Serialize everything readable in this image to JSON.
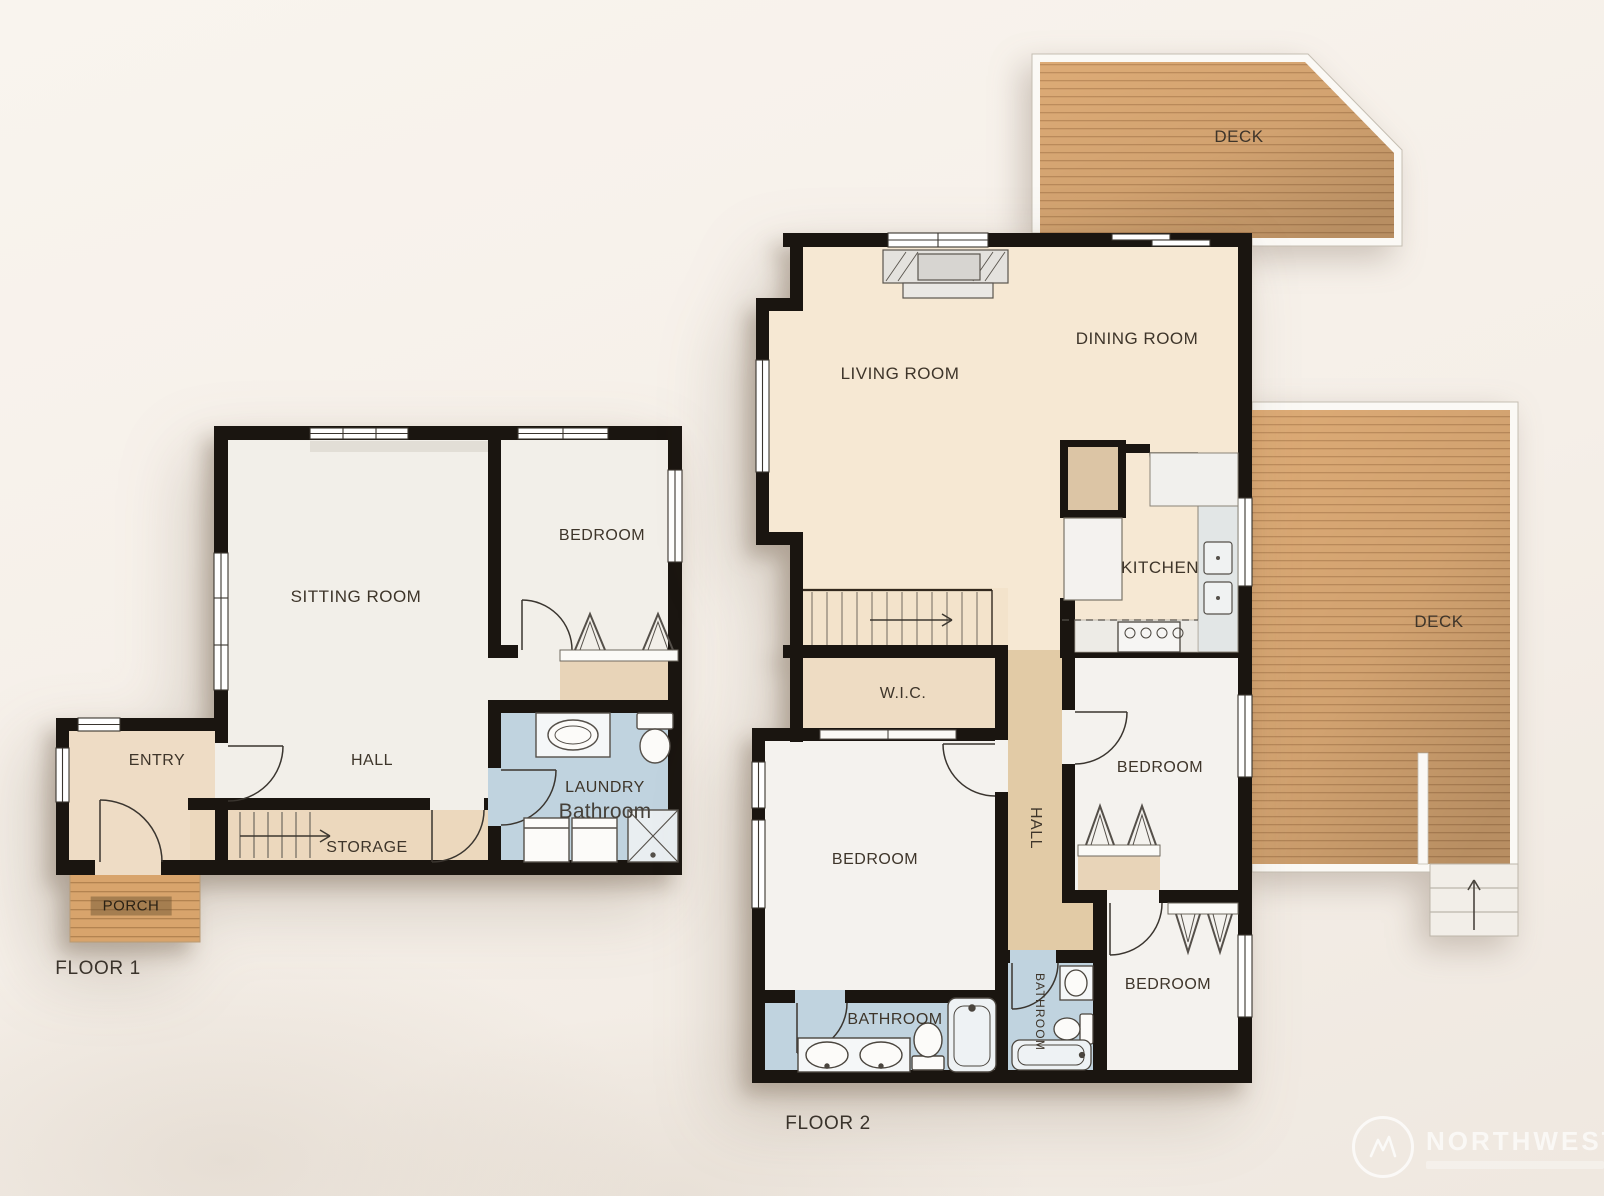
{
  "floor1": {
    "label": "FLOOR 1",
    "rooms": {
      "entry": "ENTRY",
      "sitting_room": "SITTING ROOM",
      "bedroom": "BEDROOM",
      "hall": "HALL",
      "storage": "STORAGE",
      "laundry": "LAUNDRY",
      "bathroom": "Bathroom",
      "porch": "PORCH"
    }
  },
  "floor2": {
    "label": "FLOOR 2",
    "rooms": {
      "deck_top": "DECK",
      "deck_right": "DECK",
      "living_room": "LIVING ROOM",
      "dining_room": "DINING ROOM",
      "kitchen": "KITCHEN",
      "wic": "W.I.C.",
      "hall": "HALL",
      "bedroom_master": "BEDROOM",
      "bedroom_mid": "BEDROOM",
      "bedroom_lower": "BEDROOM",
      "bathroom_master": "BATHROOM",
      "bathroom_small": "BATHROOM"
    }
  },
  "watermark": {
    "brand": "NORTHWEST"
  },
  "colors": {
    "background": "#f5efe8",
    "wall": "#1a1510",
    "deck_wood": "#ddab76",
    "porch_wood": "#d8a46c",
    "bathroom_floor": "#c0d3df",
    "hall_floor": "#e2cba6",
    "cream_floor": "#f6e8d3",
    "room_floor": "#f4f2ee",
    "closet_floor": "#e8d4b8",
    "label_text": "#3e352a"
  }
}
